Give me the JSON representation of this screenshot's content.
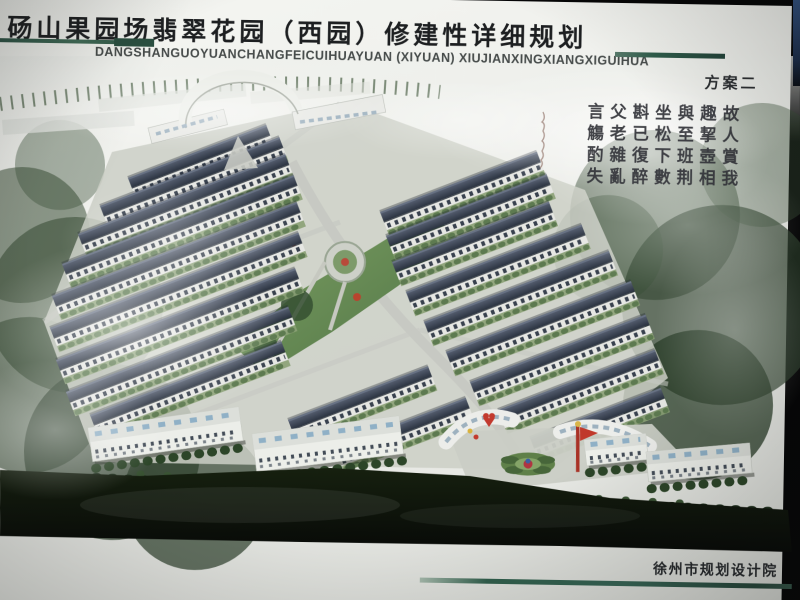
{
  "poster": {
    "title": "砀山果园场翡翠花园（西园）修建性详细规划",
    "title_pinyin": "DANGSHANGUOYUANCHANGFEICUIHUAYUAN (XIYUAN) XIUJIANXINGXIANGXIGUIHUA",
    "scheme_label": "方案二",
    "institute": "徐州市规划设计院",
    "calligraphy_poem": {
      "reading_order": "vertical columns, right to left",
      "columns_right_to_left": [
        "故人賞我",
        "趣挈壺相",
        "與至班荆",
        "坐松下數",
        "斟已復醉",
        "父老雜亂",
        "言觴酌失"
      ]
    },
    "colors": {
      "accent_green": "#2e5747",
      "title_ink": "#1d1f21",
      "roof_slate": "#333b49",
      "foliage_dark": "#2c4028",
      "entry_red": "#c0392b"
    }
  }
}
